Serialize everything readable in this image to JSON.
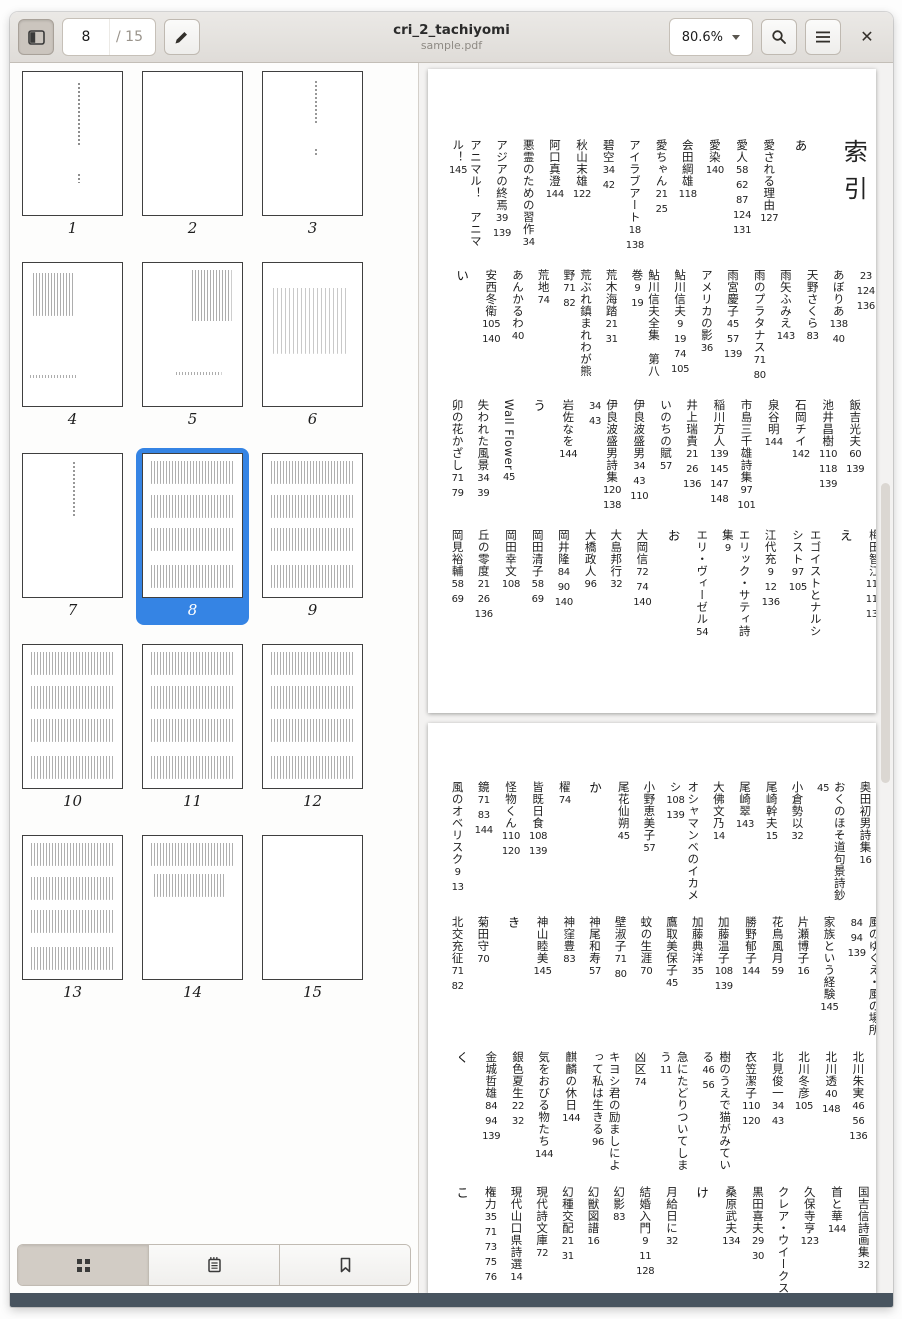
{
  "window": {
    "title": "cri_2_tachiyomi",
    "subtitle": "sample.pdf"
  },
  "toolbar": {
    "page_current": "8",
    "page_total": "/ 15",
    "zoom_level": "80.6%"
  },
  "sidebar": {
    "active_page": "8",
    "pages": [
      {
        "n": "1",
        "pattern": "title"
      },
      {
        "n": "2",
        "pattern": "blank"
      },
      {
        "n": "3",
        "pattern": "title2"
      },
      {
        "n": "4",
        "pattern": "blockTL"
      },
      {
        "n": "5",
        "pattern": "blockTR"
      },
      {
        "n": "6",
        "pattern": "scatter"
      },
      {
        "n": "7",
        "pattern": "line"
      },
      {
        "n": "8",
        "pattern": "dense"
      },
      {
        "n": "9",
        "pattern": "dense"
      },
      {
        "n": "10",
        "pattern": "dense"
      },
      {
        "n": "11",
        "pattern": "dense"
      },
      {
        "n": "12",
        "pattern": "dense"
      },
      {
        "n": "13",
        "pattern": "dense"
      },
      {
        "n": "14",
        "pattern": "dense2"
      },
      {
        "n": "15",
        "pattern": "blank"
      }
    ]
  },
  "index": {
    "title": "索引",
    "pages": [
      {
        "bands": [
          {
            "items": [
              {
                "sec": "あ"
              },
              {
                "t": "愛される理由",
                "p": [
                  "127"
                ]
              },
              {
                "t": "愛人",
                "p": [
                  "58",
                  "62",
                  "87",
                  "124",
                  "131"
                ]
              },
              {
                "t": "愛染",
                "p": [
                  "140"
                ]
              },
              {
                "t": "会田綱雄",
                "p": [
                  "118"
                ]
              },
              {
                "t": "愛ちゃん",
                "p": [
                  "21",
                  "25"
                ]
              },
              {
                "t": "アイラブアート",
                "p": [
                  "18",
                  "138"
                ]
              },
              {
                "t": "碧空",
                "p": [
                  "34",
                  "42"
                ]
              },
              {
                "t": "秋山末雄",
                "p": [
                  "122"
                ]
              },
              {
                "t": "阿口真澄",
                "p": [
                  "144"
                ]
              },
              {
                "t": "悪霊のための習作",
                "p": [
                  "34"
                ]
              },
              {
                "t": "アジアの終焉",
                "p": [
                  "39",
                  "139"
                ]
              },
              {
                "t": "アニマル！　アニマル！",
                "p": [
                  "145"
                ]
              }
            ]
          },
          {
            "items": [
              {
                "t": "阿部裕一",
                "p": [
                  "84",
                  "93",
                  "139",
                  "21",
                  "23",
                  "124",
                  "136"
                ]
              },
              {
                "t": "あぼりあ",
                "p": [
                  "138",
                  "40"
                ]
              },
              {
                "t": "天野さくら",
                "p": [
                  "83"
                ]
              },
              {
                "t": "雨矢ふみえ",
                "p": [
                  "143"
                ]
              },
              {
                "t": "雨のプラタナス",
                "p": [
                  "71",
                  "80"
                ]
              },
              {
                "t": "雨宮慶子",
                "p": [
                  "45",
                  "57",
                  "139"
                ]
              },
              {
                "t": "アメリカの影",
                "p": [
                  "36"
                ]
              },
              {
                "t": "鮎川信夫",
                "p": [
                  "9",
                  "19",
                  "74",
                  "105"
                ]
              },
              {
                "t": "鮎川信夫全集　第八巻",
                "p": [
                  "9",
                  "19"
                ]
              },
              {
                "t": "荒木海踏",
                "p": [
                  "21",
                  "31"
                ]
              },
              {
                "t": "荒ぶれ鎮まれわが熊野",
                "p": [
                  "71",
                  "82"
                ]
              },
              {
                "t": "荒地",
                "p": [
                  "74"
                ]
              },
              {
                "t": "あんかるわ",
                "p": [
                  "40"
                ]
              },
              {
                "t": "安西冬衛",
                "p": [
                  "105",
                  "140"
                ]
              },
              {
                "sec": "い"
              }
            ]
          },
          {
            "items": [
              {
                "t": "飯吉光夫",
                "p": [
                  "60",
                  "139"
                ]
              },
              {
                "t": "池井昌樹",
                "p": [
                  "110",
                  "118",
                  "139"
                ]
              },
              {
                "t": "石岡チイ",
                "p": [
                  "142"
                ]
              },
              {
                "t": "泉谷明",
                "p": [
                  "144"
                ]
              },
              {
                "t": "市島三千雄詩集",
                "p": [
                  "97",
                  "101"
                ]
              },
              {
                "t": "稲川方人",
                "p": [
                  "139",
                  "145",
                  "147",
                  "148"
                ]
              },
              {
                "t": "井上瑞貴",
                "p": [
                  "21",
                  "26",
                  "136"
                ]
              },
              {
                "t": "いのちの賦",
                "p": [
                  "57"
                ]
              },
              {
                "t": "伊良波盛男",
                "p": [
                  "34",
                  "43",
                  "110"
                ]
              },
              {
                "t": "伊良波盛男詩集",
                "p": [
                  "120",
                  "138",
                  "34",
                  "43"
                ]
              },
              {
                "t": "岩佐なを",
                "p": [
                  "144"
                ]
              },
              {
                "sec": "う"
              },
              {
                "t": "Wall Flower",
                "p": [
                  "45"
                ]
              },
              {
                "t": "失われた風景",
                "p": [
                  "34",
                  "39"
                ]
              },
              {
                "t": "卯の花かざし",
                "p": [
                  "71",
                  "79"
                ]
              }
            ]
          },
          {
            "items": [
              {
                "t": "梅田智江",
                "p": [
                  "110",
                  "117",
                  "138"
                ]
              },
              {
                "sec": "え"
              },
              {
                "t": "エゴイストとナルシシスト",
                "p": [
                  "97",
                  "105"
                ]
              },
              {
                "t": "江代充",
                "p": [
                  "9",
                  "12",
                  "136"
                ]
              },
              {
                "t": "エリック・サティ詩集",
                "p": [
                  "9"
                ]
              },
              {
                "t": "エリ・ヴィーゼル",
                "p": [
                  "54"
                ]
              },
              {
                "sec": "お"
              },
              {
                "t": "大岡信",
                "p": [
                  "72",
                  "74",
                  "140"
                ]
              },
              {
                "t": "大島邦行",
                "p": [
                  "32"
                ]
              },
              {
                "t": "大橋政人",
                "p": [
                  "96"
                ]
              },
              {
                "t": "岡井隆",
                "p": [
                  "84",
                  "90",
                  "140"
                ]
              },
              {
                "t": "岡田清子",
                "p": [
                  "58",
                  "69"
                ]
              },
              {
                "t": "岡田幸文",
                "p": [
                  "108"
                ]
              },
              {
                "t": "丘の零度",
                "p": [
                  "21",
                  "26",
                  "136"
                ]
              },
              {
                "t": "岡見裕輔",
                "p": [
                  "58",
                  "69"
                ]
              }
            ]
          }
        ]
      },
      {
        "bands": [
          {
            "items": [
              {
                "t": "小串伸夫",
                "p": [
                  "16"
                ]
              },
              {
                "t": "奥田初男詩集",
                "p": [
                  "16"
                ]
              },
              {
                "t": "おくのほそ道句景詩鈔",
                "p": [
                  "45"
                ]
              },
              {
                "t": "小倉勢以",
                "p": [
                  "32"
                ]
              },
              {
                "t": "尾崎幹夫",
                "p": [
                  "15"
                ]
              },
              {
                "t": "尾崎翠",
                "p": [
                  "143"
                ]
              },
              {
                "t": "大佛文乃",
                "p": [
                  "14"
                ]
              },
              {
                "t": "オシャマンベのイカメシ",
                "p": [
                  "108",
                  "139"
                ]
              },
              {
                "t": "小野恵美子",
                "p": [
                  "57"
                ]
              },
              {
                "t": "尾花仙朔",
                "p": [
                  "45"
                ]
              },
              {
                "sec": "か"
              },
              {
                "t": "櫂",
                "p": [
                  "74"
                ]
              },
              {
                "t": "皆既日食",
                "p": [
                  "108",
                  "139"
                ]
              },
              {
                "t": "怪物くん",
                "p": [
                  "110",
                  "120"
                ]
              },
              {
                "t": "鏡",
                "p": [
                  "71",
                  "83",
                  "144"
                ]
              },
              {
                "t": "風のオベリスク",
                "p": [
                  "9",
                  "13"
                ]
              }
            ]
          },
          {
            "items": [
              {
                "t": "風の岬で",
                "p": [
                  "46",
                  "53",
                  "124",
                  "135"
                ]
              },
              {
                "t": "風のゆくえ・風の場所",
                "p": [
                  "84",
                  "94",
                  "139"
                ]
              },
              {
                "t": "家族という経験",
                "p": [
                  "145"
                ]
              },
              {
                "t": "片瀬博子",
                "p": [
                  "16"
                ]
              },
              {
                "t": "花鳥風月",
                "p": [
                  "59"
                ]
              },
              {
                "t": "勝野郁子",
                "p": [
                  "144"
                ]
              },
              {
                "t": "加藤温子",
                "p": [
                  "108",
                  "139"
                ]
              },
              {
                "t": "加藤典洋",
                "p": [
                  "35"
                ]
              },
              {
                "t": "鷹取美保子",
                "p": [
                  "45"
                ]
              },
              {
                "t": "蚊の生涯",
                "p": [
                  "70"
                ]
              },
              {
                "t": "壁淑子",
                "p": [
                  "71",
                  "80"
                ]
              },
              {
                "t": "神尾和寿",
                "p": [
                  "57"
                ]
              },
              {
                "t": "神窪豊",
                "p": [
                  "83"
                ]
              },
              {
                "t": "神山睦美",
                "p": [
                  "145"
                ]
              },
              {
                "sec": "き"
              },
              {
                "t": "菊田守",
                "p": [
                  "70"
                ]
              },
              {
                "t": "北交充征",
                "p": [
                  "71",
                  "82"
                ]
              }
            ]
          },
          {
            "items": [
              {
                "t": "北垣健二",
                "p": [
                  "21",
                  "22"
                ]
              },
              {
                "t": "北川朱実",
                "p": [
                  "46",
                  "56",
                  "136"
                ]
              },
              {
                "t": "北川透",
                "p": [
                  "40",
                  "148"
                ]
              },
              {
                "t": "北川冬彦",
                "p": [
                  "105"
                ]
              },
              {
                "t": "北見俊一",
                "p": [
                  "34",
                  "43"
                ]
              },
              {
                "t": "衣笠潔子",
                "p": [
                  "110",
                  "120"
                ]
              },
              {
                "t": "樹のうえで猫がみている",
                "p": [
                  "46",
                  "56"
                ]
              },
              {
                "t": "急にたどりついてしまう",
                "p": [
                  "11"
                ]
              },
              {
                "t": "凶区",
                "p": [
                  "74"
                ]
              },
              {
                "t": "キヨシ君の励ましによって私は生きる",
                "p": [
                  "96"
                ]
              },
              {
                "t": "麒麟の休日",
                "p": [
                  "144"
                ]
              },
              {
                "t": "気をおびる物たち",
                "p": [
                  "144"
                ]
              },
              {
                "t": "銀色夏生",
                "p": [
                  "22",
                  "32"
                ]
              },
              {
                "t": "金城哲雄",
                "p": [
                  "84",
                  "94",
                  "139"
                ]
              },
              {
                "sec": "く"
              }
            ]
          },
          {
            "items": [
              {
                "t": "クッキング・タイム",
                "p": [
                  "58"
                ]
              },
              {
                "t": "国吉信詩画集",
                "p": [
                  "32"
                ]
              },
              {
                "t": "首と華",
                "p": [
                  "144"
                ]
              },
              {
                "t": "久保寺亨",
                "p": [
                  "123"
                ]
              },
              {
                "t": "クレア・ウイークス",
                "p": []
              },
              {
                "t": "黒田喜夫",
                "p": [
                  "29",
                  "30"
                ]
              },
              {
                "t": "桑原武夫",
                "p": [
                  "134"
                ]
              },
              {
                "sec": "け"
              },
              {
                "t": "月給日に",
                "p": [
                  "32"
                ]
              },
              {
                "t": "結婚入門",
                "p": [
                  "9",
                  "11",
                  "128"
                ]
              },
              {
                "t": "幻影",
                "p": [
                  "83"
                ]
              },
              {
                "t": "幻獣図譜",
                "p": [
                  "16"
                ]
              },
              {
                "t": "幻種交配",
                "p": [
                  "21",
                  "31"
                ]
              },
              {
                "t": "現代詩文庫",
                "p": [
                  "72"
                ]
              },
              {
                "t": "現代山口県詩選",
                "p": [
                  "14"
                ]
              },
              {
                "t": "権力",
                "p": [
                  "35",
                  "71",
                  "73",
                  "75",
                  "76"
                ]
              },
              {
                "sec": "こ"
              }
            ]
          }
        ]
      }
    ]
  }
}
